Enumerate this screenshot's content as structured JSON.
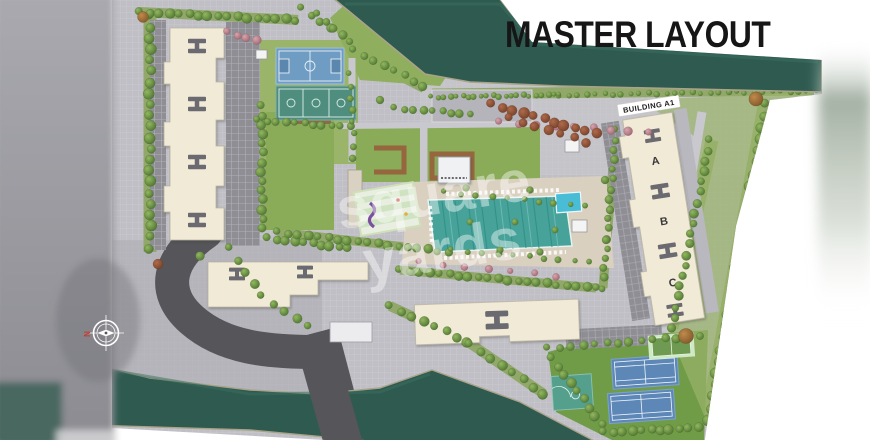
{
  "title": "MASTER LAYOUT",
  "watermark": {
    "line1": "square",
    "line2": "yards"
  },
  "building_a1": {
    "label": "BUILDING A1",
    "wings": [
      "A",
      "B",
      "C"
    ]
  },
  "compass": {
    "north": "N"
  },
  "colors": {
    "title_text": "#161616",
    "water": "#2e5a50",
    "grass": "#8aab57",
    "turf": "#719c47",
    "building": "#f1ead7",
    "paving": "#bfbfc5",
    "road": "#565559",
    "deck": "#d9d0bf",
    "pool": "#47a29a",
    "kids_pool": "#48bdd5",
    "court_blue": "#6e9cc3",
    "court_teal": "#4f8d7e",
    "tennis_blue": "#5d87b7"
  }
}
